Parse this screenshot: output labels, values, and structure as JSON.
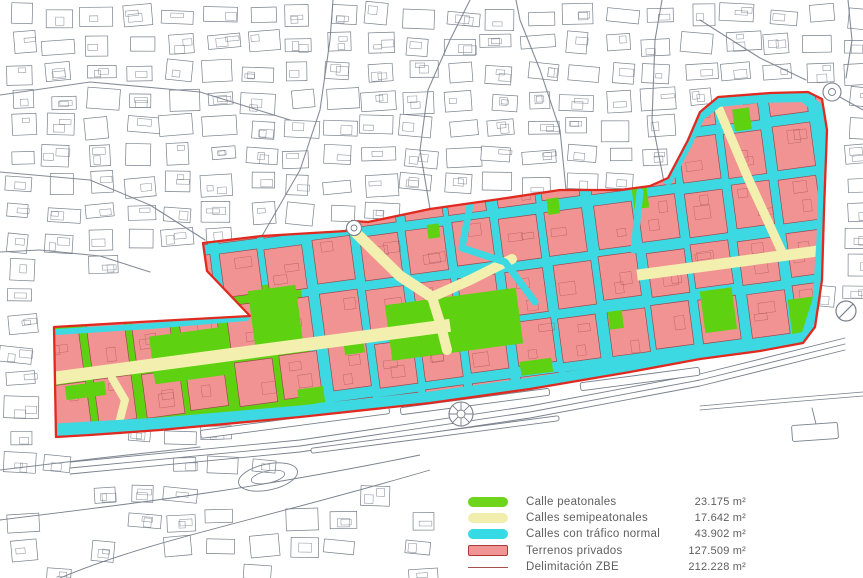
{
  "legend": {
    "items": [
      {
        "id": "pedestrian",
        "label": "Calle peatonales",
        "area": "23.175 m²",
        "color": "#6fd41c",
        "style": "pill"
      },
      {
        "id": "semipedestrian",
        "label": "Calles semipeatonales",
        "area": "17.642 m²",
        "color": "#f2efae",
        "style": "pill"
      },
      {
        "id": "traffic",
        "label": "Calles con tráfico normal",
        "area": "43.902 m²",
        "color": "#35dae4",
        "style": "pill"
      },
      {
        "id": "private",
        "label": "Terrenos privados",
        "area": "127.509 m²",
        "color": "#f19494",
        "border": "#a93a3a",
        "style": "box"
      },
      {
        "id": "zbe",
        "label": "Delimitación ZBE",
        "area": "212.228 m²",
        "color": "#a85050",
        "style": "line"
      }
    ]
  },
  "map": {
    "colors": {
      "paper": "#ffffff",
      "background_line": "#78808c",
      "pedestrian": "#5ed110",
      "semipedestrian": "#f3efae",
      "traffic": "#3cd9e2",
      "private": "#f19393",
      "private_outline": "#9c4a4e",
      "zbe_line": "#e02a20"
    }
  }
}
